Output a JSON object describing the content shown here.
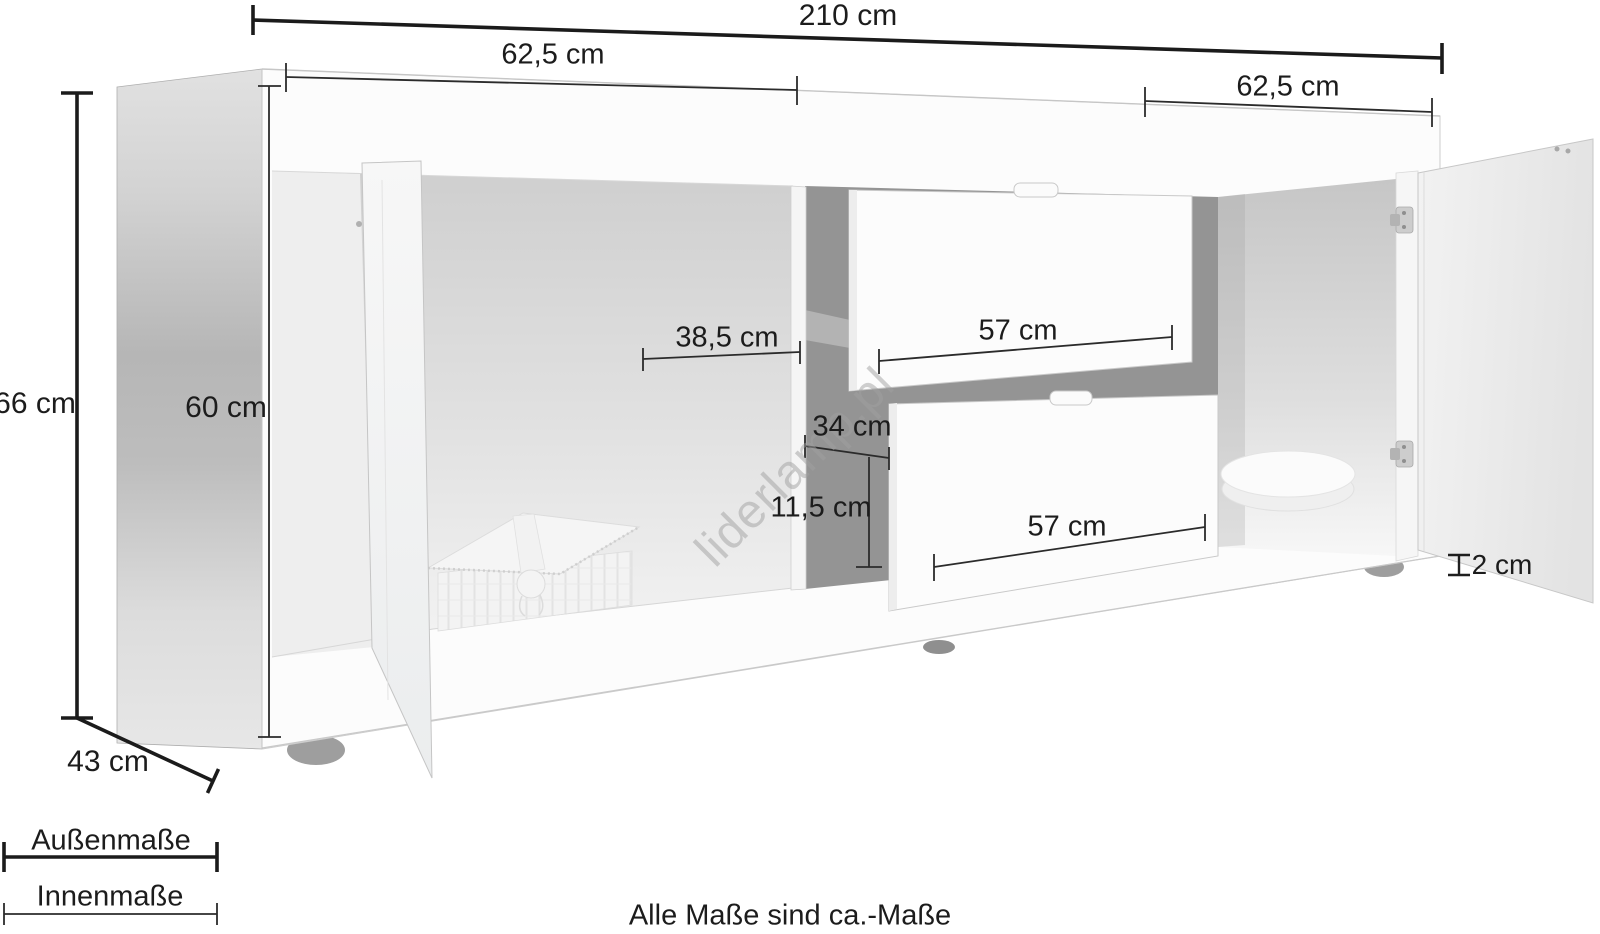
{
  "watermark": "liderlamp.pl",
  "note": "Alle Maße sind ca.-Maße",
  "legend": {
    "outer_label": "Außenmaße",
    "inner_label": "Innenmaße"
  },
  "dimensions": {
    "total_width": "210 cm",
    "left_section_width": "62,5 cm",
    "right_section_width": "62,5 cm",
    "outer_height": "66 cm",
    "inner_height": "60 cm",
    "left_inner_width": "38,5 cm",
    "top_drawer_width": "57 cm",
    "middle_inner_width": "34 cm",
    "drawer_inner_height": "11,5 cm",
    "bottom_drawer_width": "57 cm",
    "panel_thickness": "2 cm",
    "depth": "43 cm"
  }
}
